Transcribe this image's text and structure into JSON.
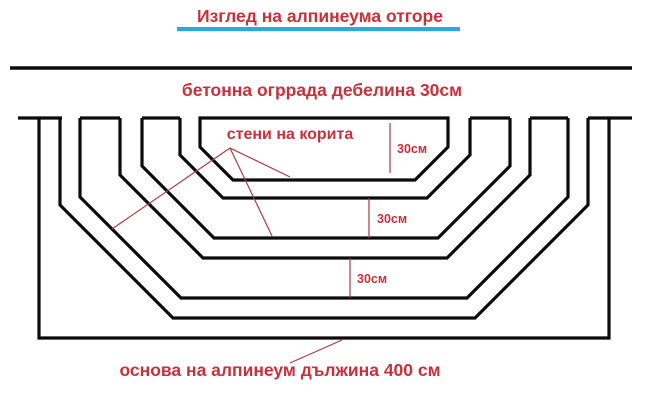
{
  "diagram": {
    "title": "Изглед на алпинеума отгоре",
    "fence_label": "бетонна огррада дебелина 30см",
    "trough_walls_label": "стени на корита",
    "base_label": "основа на алпинеум дължина 400 см",
    "dim_labels": [
      "30см",
      "30см",
      "30см"
    ]
  },
  "colors": {
    "text_red": "#c8303a",
    "annotation_red": "#aa3c42",
    "underline_blue": "#2ba8e0",
    "line_black": "#0b0b0b",
    "background": "#ffffff"
  }
}
